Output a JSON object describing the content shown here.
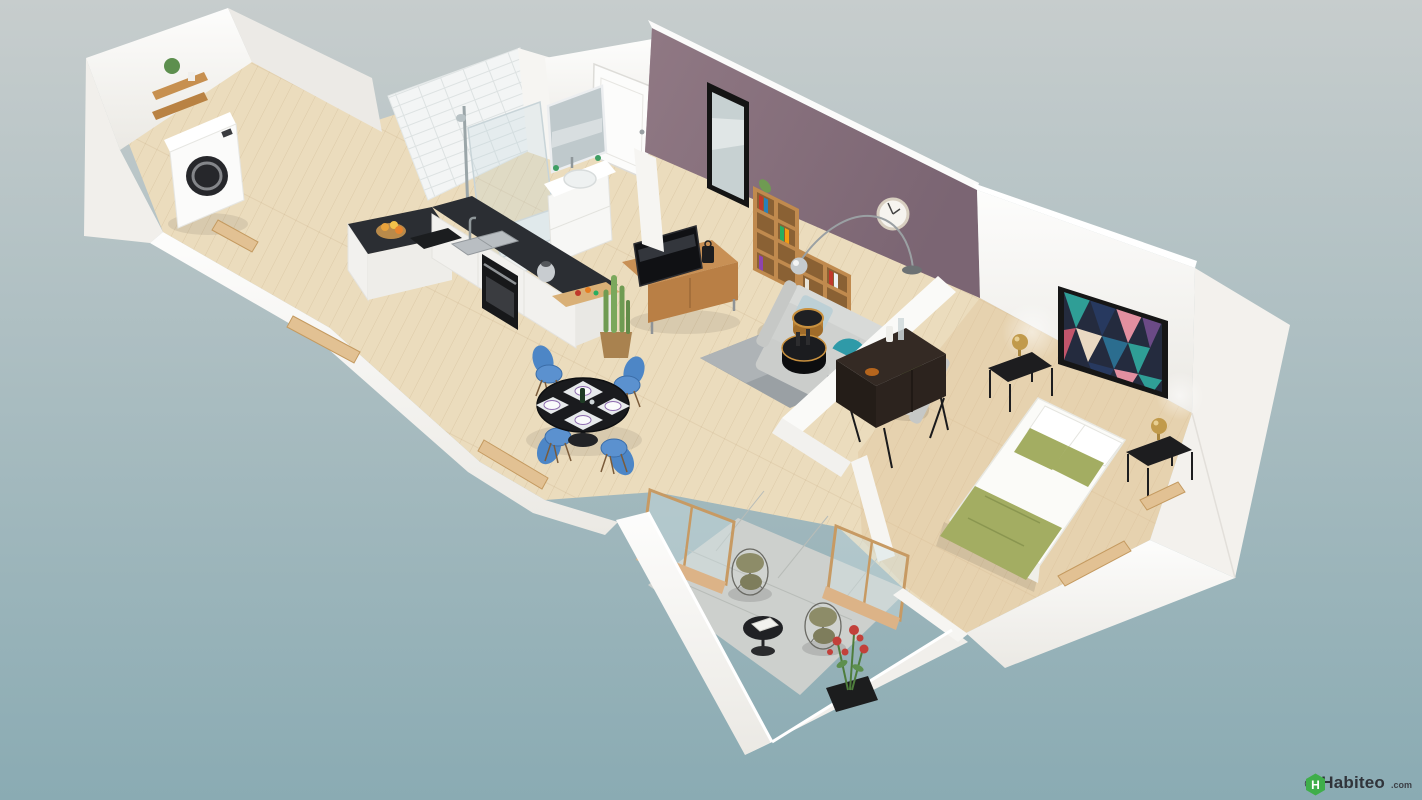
{
  "watermark": {
    "copyright_symbol": "©",
    "brand": "Habiteo",
    "domain_suffix": ".com",
    "logo_letter": "H",
    "logo_color": "#3fae4a",
    "text_color": "#30343a"
  },
  "scene": {
    "description": "3D isometric floor-plan render of a one-bedroom apartment with balcony",
    "colors": {
      "background_top": "#c7cdcd",
      "background_bottom": "#8aabb3",
      "wall_white": "#f8f7f5",
      "wall_shadow": "#e9e7e2",
      "accent_wall": "#8b7380",
      "accent_wall_dark": "#6e5a68",
      "floor_wood": "#ebdcbd",
      "floor_wood_bedroom": "#dfc49c",
      "balcony_tile": "#cdd0cd",
      "countertop": "#2b2e33",
      "cabinet_white": "#f4f3f0",
      "sofa_gray": "#cfd1cf",
      "rug_gray": "#9aa0a4",
      "dining_chair_blue": "#4d86c6",
      "dining_table_black": "#1a1b1e",
      "bed_linen": "#fbfbf8",
      "bed_green": "#a3ad62",
      "wood_furniture": "#c89055",
      "dark_console": "#342a24",
      "brass": "#c19a4b",
      "plant_green": "#6f9b52",
      "flower_red": "#c2403a",
      "artwork_palette": [
        "#2f9e96",
        "#27395f",
        "#e28fa0",
        "#6b4a86",
        "#ead9c2",
        "#2b6d8f"
      ]
    },
    "rooms": [
      {
        "name": "laundry",
        "furniture": [
          "washing-machine",
          "wall-shelf",
          "plant"
        ]
      },
      {
        "name": "bathroom",
        "furniture": [
          "walk-in-shower",
          "glass-screen",
          "shower-tray",
          "vanity-sink",
          "vanity-mirror"
        ]
      },
      {
        "name": "entry",
        "furniture": [
          "front-door",
          "wall-mirror"
        ]
      },
      {
        "name": "kitchen",
        "furniture": [
          "l-shaped-counter",
          "sink",
          "cooktop",
          "oven",
          "fruit-basket",
          "cutting-board",
          "kettle"
        ]
      },
      {
        "name": "living-room",
        "furniture": [
          "gray-sofa",
          "rug",
          "drum-coffee-tables",
          "tv",
          "tv-stand",
          "cube-bookshelf",
          "arc-floor-lamp",
          "wall-clock",
          "cactus-plant"
        ]
      },
      {
        "name": "dining-area",
        "furniture": [
          "round-black-table",
          "blue-eiffel-chairs",
          "place-settings",
          "wine-bottle"
        ]
      },
      {
        "name": "bedroom",
        "furniture": [
          "double-bed",
          "green-bedding",
          "nightstands",
          "brass-lamps",
          "dark-sideboard",
          "abstract-wall-art"
        ]
      },
      {
        "name": "balcony",
        "furniture": [
          "wire-chairs",
          "black-side-table",
          "flowering-plant",
          "sliding-glass-doors"
        ]
      }
    ]
  }
}
